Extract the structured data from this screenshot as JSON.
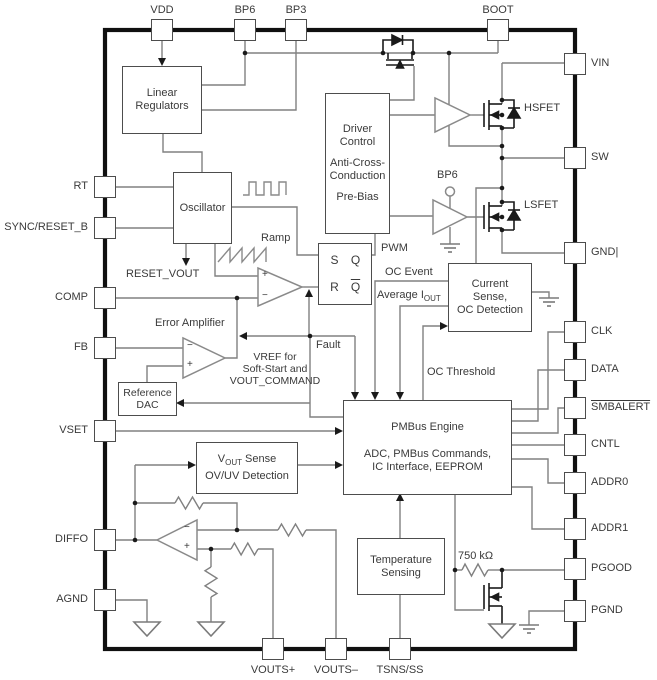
{
  "diagram": {
    "pins": {
      "top": [
        {
          "label": "VDD"
        },
        {
          "label": "BP6"
        },
        {
          "label": "BP3"
        },
        {
          "label": "BOOT"
        }
      ],
      "left": [
        {
          "label": "RT"
        },
        {
          "label": "SYNC/RESET_B"
        },
        {
          "label": "COMP"
        },
        {
          "label": "FB"
        },
        {
          "label": "VSET"
        },
        {
          "label": "DIFFO"
        },
        {
          "label": "AGND"
        }
      ],
      "right": [
        {
          "label": "VIN"
        },
        {
          "label": "SW"
        },
        {
          "label": "GND|"
        },
        {
          "label": "CLK"
        },
        {
          "label": "DATA"
        },
        {
          "label": "SMBALERT"
        },
        {
          "label": "CNTL"
        },
        {
          "label": "ADDR0"
        },
        {
          "label": "ADDR1"
        },
        {
          "label": "PGOOD"
        },
        {
          "label": "PGND"
        }
      ],
      "bottom": [
        {
          "label": "VOUTS+"
        },
        {
          "label": "VOUTS–"
        },
        {
          "label": "TSNS/SS"
        }
      ]
    },
    "blocks": {
      "linear_regulators": {
        "l1": "Linear",
        "l2": "Regulators"
      },
      "oscillator": {
        "l1": "Oscillator"
      },
      "driver_control": {
        "l1": "Driver",
        "l2": "Control",
        "l3": "Anti-Cross-",
        "l4": "Conduction",
        "l5": "Pre-Bias"
      },
      "pwm_latch": {
        "s": "S",
        "q": "Q",
        "r": "R",
        "qbar": "Q"
      },
      "current_sense": {
        "l1": "Current",
        "l2": "Sense,",
        "l3": "OC Detection"
      },
      "reference_dac": {
        "l1": "Reference",
        "l2": "DAC"
      },
      "pmbus_engine": {
        "title": "PMBus Engine",
        "l1": "ADC, PMBus Commands,",
        "l2": "IC Interface, EEPROM"
      },
      "vout_sense": {
        "pre": "V",
        "sub": "OUT",
        "post": " Sense",
        "l2": "OV/UV Detection"
      },
      "temperature": {
        "l1": "Temperature",
        "l2": "Sensing"
      }
    },
    "labels": {
      "ramp": "Ramp",
      "reset_vout": "RESET_VOUT",
      "pwm": "PWM",
      "oc_event": "OC Event",
      "avg_iout_pre": "Average I",
      "avg_iout_sub": "OUT",
      "fault": "Fault",
      "oc_threshold": "OC Threshold",
      "vref_l1": "VREF for",
      "vref_l2": "Soft-Start and",
      "vref_l3": "VOUT_COMMAND",
      "error_amplifier": "Error Amplifier",
      "bp6_internal": "BP6",
      "hsfet": "HSFET",
      "lsfet": "LSFET",
      "pullup_resistor": "750 kΩ",
      "plus": "+",
      "minus": "−"
    },
    "colors": {
      "wire": "#808080",
      "ink": "#3a3a3a",
      "chip_border": "#101010"
    }
  }
}
